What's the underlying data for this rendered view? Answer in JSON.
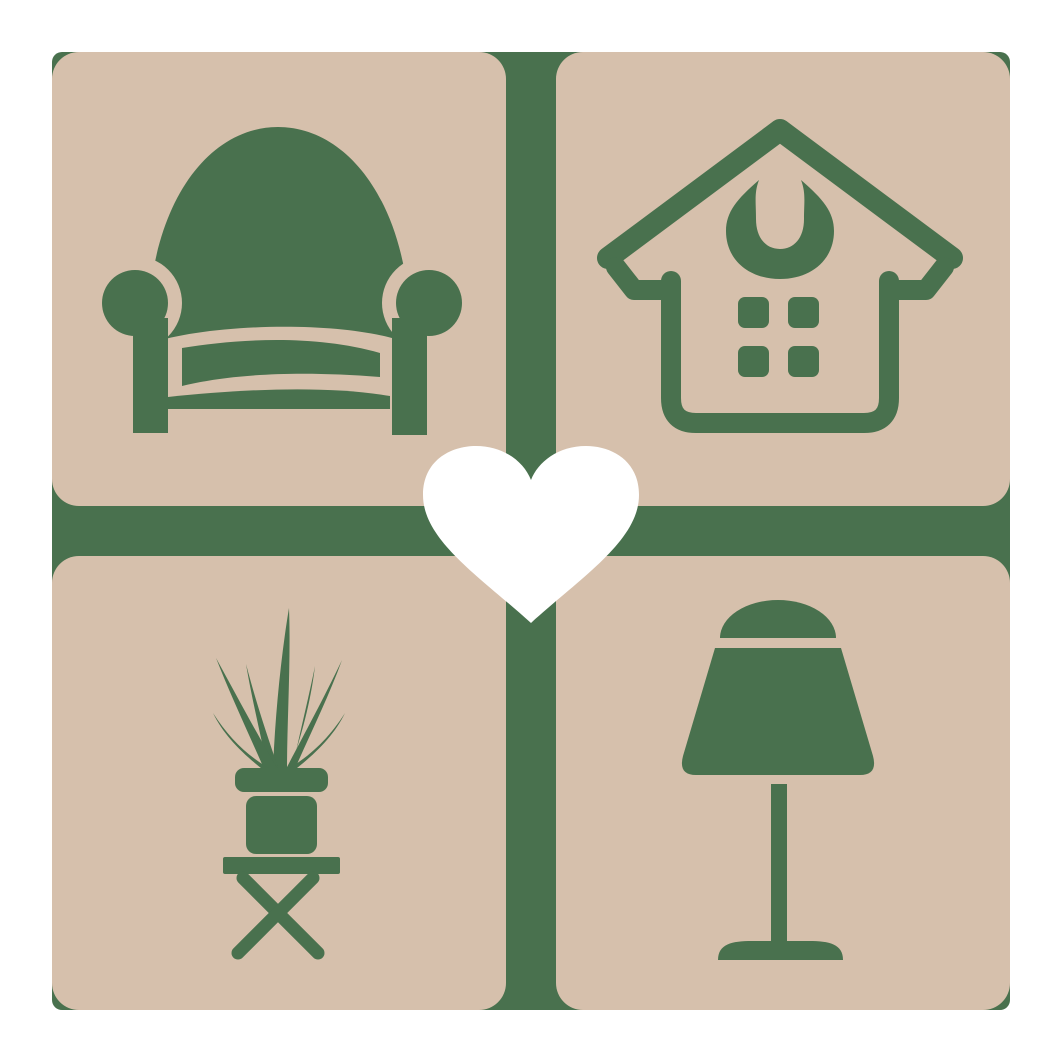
{
  "title": "Home decor love logo",
  "colors": {
    "page_bg": "#ffffff",
    "backdrop_green": "#49714E",
    "tile_tan": "#D6C0AC",
    "icon_green": "#49714E",
    "heart_white": "#ffffff"
  },
  "logo": {
    "backdrop_shape": "rounded-square-cross",
    "tiles": [
      {
        "position": "top-left",
        "icon": "armchair"
      },
      {
        "position": "top-right",
        "icon": "house"
      },
      {
        "position": "bottom-left",
        "icon": "potted-plant"
      },
      {
        "position": "bottom-right",
        "icon": "table-lamp"
      }
    ],
    "center_icon": "heart"
  }
}
